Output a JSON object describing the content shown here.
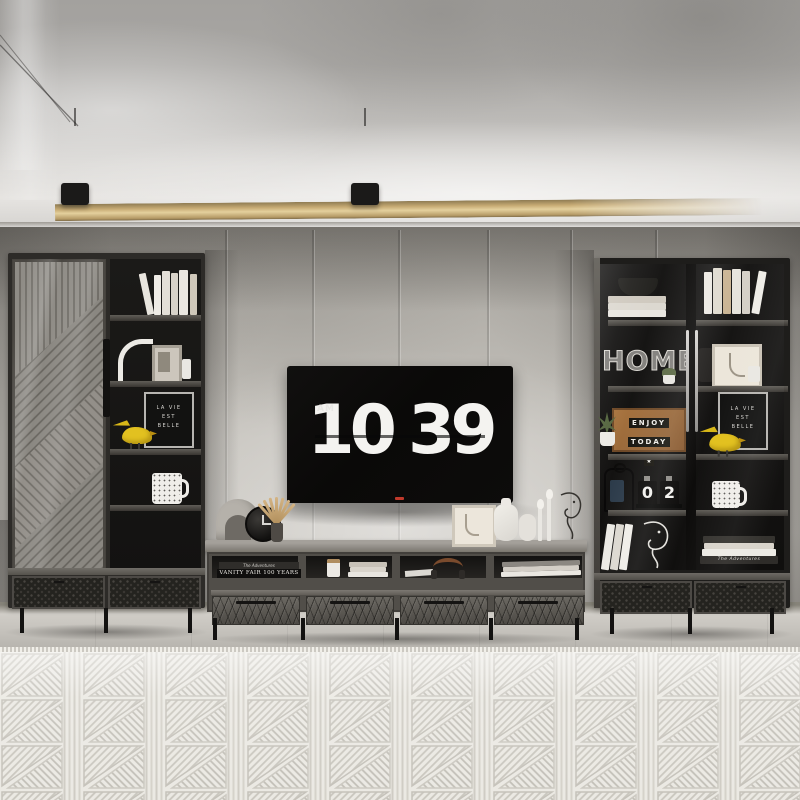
{
  "tv": {
    "clock": {
      "meridiem": "AM",
      "hours": "10",
      "minutes": "39"
    }
  },
  "left_cabinet": {
    "letter_board_lines": [
      "LA VIE",
      "EST",
      "BELLE"
    ]
  },
  "right_cabinet": {
    "wire_word": "HOME",
    "lightbox_lines": [
      "ENJOY",
      "TODAY"
    ],
    "lightbox_star": "★",
    "flip_calendar_digits": [
      "0",
      "2"
    ],
    "letter_board_lines": [
      "LA VIE",
      "EST",
      "BELLE"
    ],
    "stacked_book_spine": "The Adventures"
  },
  "console": {
    "shelf_book_spine_top": "The Adventures",
    "shelf_book_spine_main": "VANITY FAIR 100 YEARS"
  },
  "palette": {
    "accent_yellow": "#e2c120",
    "led_strip_warm": "#cdb379",
    "sign_wood_brown": "#9c6a41",
    "screen_black": "#0a0908",
    "clock_digits_white": "#f4f3f0",
    "cabinet_charcoal": "#2c2a27",
    "wall_concrete_gray": "#bab7b1",
    "rug_ivory": "#ebe9e3",
    "floor_gray_wood": "#c6c3bd",
    "tv_brand_dot_red": "#c0392b"
  }
}
